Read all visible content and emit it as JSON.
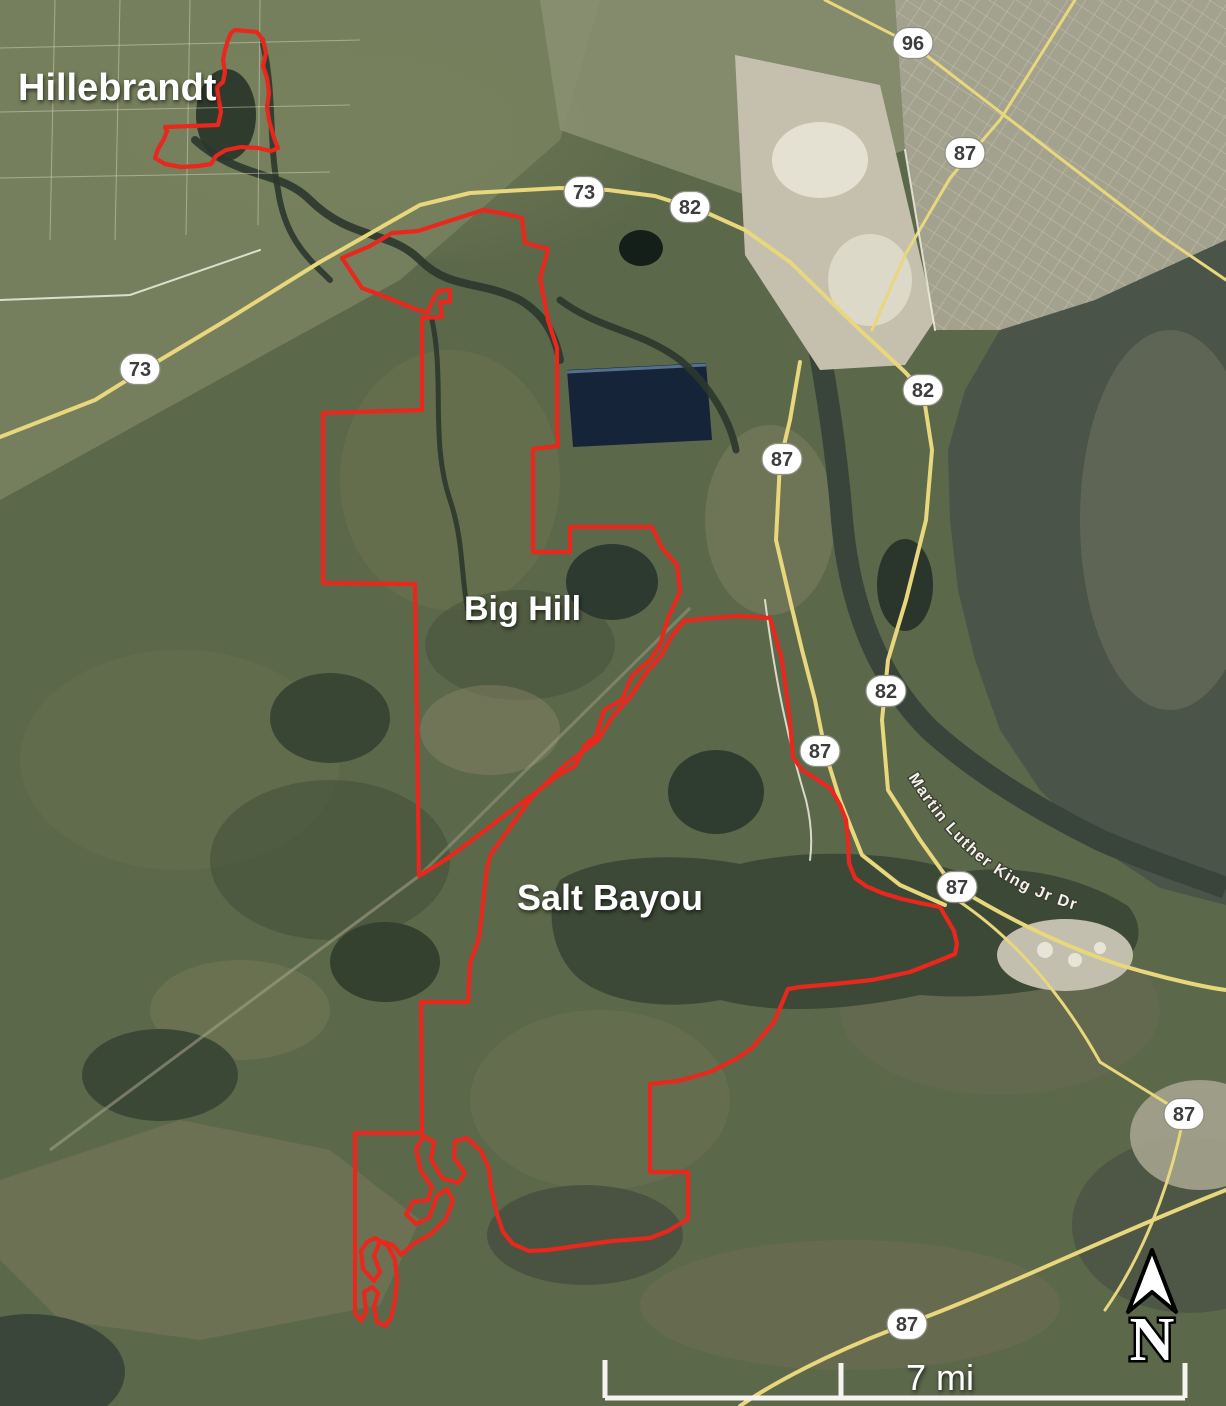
{
  "title": "Satellite map of Hillebrandt, Big Hill and Salt Bayou management areas",
  "labels": {
    "area_hillebrandt": "Hillebrandt",
    "area_big_hill": "Big Hill",
    "area_salt_bayou": "Salt Bayou",
    "road_mlk": "Martin Luther King Jr Dr"
  },
  "north_arrow": {
    "letter": "N"
  },
  "scale_bar": {
    "label": "7 mi"
  },
  "colors": {
    "boundary_red": "#e8271d",
    "highway_yellow": "#e8d77c",
    "water_dark": "#3d4937",
    "urban_gray": "#a3a28e",
    "label_white": "#ffffff"
  },
  "shields": [
    {
      "route": "96",
      "x": 913,
      "y": 43
    },
    {
      "route": "87",
      "x": 965,
      "y": 153
    },
    {
      "route": "73",
      "x": 584,
      "y": 192
    },
    {
      "route": "82",
      "x": 690,
      "y": 207
    },
    {
      "route": "73",
      "x": 140,
      "y": 369
    },
    {
      "route": "82",
      "x": 923,
      "y": 390
    },
    {
      "route": "87",
      "x": 782,
      "y": 459
    },
    {
      "route": "82",
      "x": 886,
      "y": 691
    },
    {
      "route": "87",
      "x": 820,
      "y": 751
    },
    {
      "route": "87",
      "x": 957,
      "y": 887
    },
    {
      "route": "87",
      "x": 1184,
      "y": 1114
    },
    {
      "route": "87",
      "x": 907,
      "y": 1324
    }
  ],
  "boundaries": {
    "hillebrandt": [
      [
        235,
        30
      ],
      [
        257,
        32
      ],
      [
        263,
        40
      ],
      [
        266,
        53
      ],
      [
        263,
        66
      ],
      [
        267,
        78
      ],
      [
        269,
        93
      ],
      [
        267,
        107
      ],
      [
        269,
        120
      ],
      [
        274,
        138
      ],
      [
        278,
        148
      ],
      [
        271,
        151
      ],
      [
        258,
        148
      ],
      [
        241,
        147
      ],
      [
        226,
        150
      ],
      [
        216,
        156
      ],
      [
        211,
        164
      ],
      [
        198,
        166
      ],
      [
        181,
        167
      ],
      [
        165,
        164
      ],
      [
        155,
        158
      ],
      [
        158,
        149
      ],
      [
        164,
        139
      ],
      [
        167,
        131
      ],
      [
        165,
        127
      ],
      [
        218,
        125
      ],
      [
        221,
        112
      ],
      [
        218,
        95
      ],
      [
        217,
        87
      ],
      [
        223,
        82
      ],
      [
        225,
        72
      ],
      [
        223,
        60
      ],
      [
        225,
        50
      ],
      [
        228,
        40
      ],
      [
        231,
        33
      ]
    ],
    "big_hill": [
      [
        342,
        258
      ],
      [
        370,
        246
      ],
      [
        392,
        233
      ],
      [
        418,
        231
      ],
      [
        452,
        220
      ],
      [
        483,
        210
      ],
      [
        506,
        214
      ],
      [
        522,
        218
      ],
      [
        525,
        243
      ],
      [
        548,
        249
      ],
      [
        543,
        268
      ],
      [
        540,
        278
      ],
      [
        548,
        320
      ],
      [
        557,
        348
      ],
      [
        557,
        428
      ],
      [
        558,
        446
      ],
      [
        533,
        449
      ],
      [
        533,
        552
      ],
      [
        570,
        552
      ],
      [
        570,
        527
      ],
      [
        652,
        527
      ],
      [
        662,
        548
      ],
      [
        677,
        565
      ],
      [
        680,
        592
      ],
      [
        668,
        618
      ],
      [
        660,
        645
      ],
      [
        650,
        660
      ],
      [
        632,
        676
      ],
      [
        622,
        700
      ],
      [
        604,
        710
      ],
      [
        596,
        736
      ],
      [
        585,
        745
      ],
      [
        575,
        766
      ],
      [
        560,
        774
      ],
      [
        535,
        793
      ],
      [
        505,
        815
      ],
      [
        475,
        838
      ],
      [
        445,
        860
      ],
      [
        419,
        876
      ],
      [
        415,
        584
      ],
      [
        323,
        583
      ],
      [
        323,
        413
      ],
      [
        422,
        410
      ],
      [
        422,
        318
      ],
      [
        442,
        317
      ],
      [
        440,
        302
      ],
      [
        450,
        302
      ],
      [
        450,
        290
      ],
      [
        438,
        291
      ],
      [
        433,
        300
      ],
      [
        427,
        313
      ],
      [
        410,
        307
      ],
      [
        386,
        297
      ],
      [
        362,
        288
      ]
    ],
    "salt_bayou": [
      [
        770,
        618
      ],
      [
        782,
        660
      ],
      [
        790,
        722
      ],
      [
        793,
        757
      ],
      [
        802,
        770
      ],
      [
        818,
        780
      ],
      [
        831,
        789
      ],
      [
        840,
        805
      ],
      [
        846,
        820
      ],
      [
        848,
        840
      ],
      [
        849,
        863
      ],
      [
        855,
        878
      ],
      [
        866,
        886
      ],
      [
        882,
        893
      ],
      [
        902,
        899
      ],
      [
        920,
        903
      ],
      [
        940,
        907
      ],
      [
        947,
        919
      ],
      [
        954,
        931
      ],
      [
        957,
        944
      ],
      [
        955,
        954
      ],
      [
        938,
        961
      ],
      [
        910,
        972
      ],
      [
        872,
        980
      ],
      [
        834,
        984
      ],
      [
        800,
        987
      ],
      [
        788,
        989
      ],
      [
        774,
        1022
      ],
      [
        752,
        1048
      ],
      [
        736,
        1059
      ],
      [
        710,
        1072
      ],
      [
        678,
        1081
      ],
      [
        650,
        1084
      ],
      [
        650,
        1172
      ],
      [
        688,
        1172
      ],
      [
        688,
        1219
      ],
      [
        668,
        1231
      ],
      [
        650,
        1238
      ],
      [
        612,
        1241
      ],
      [
        576,
        1246
      ],
      [
        548,
        1250
      ],
      [
        529,
        1251
      ],
      [
        513,
        1244
      ],
      [
        503,
        1232
      ],
      [
        497,
        1214
      ],
      [
        491,
        1188
      ],
      [
        489,
        1169
      ],
      [
        481,
        1151
      ],
      [
        467,
        1138
      ],
      [
        455,
        1141
      ],
      [
        454,
        1158
      ],
      [
        465,
        1173
      ],
      [
        458,
        1183
      ],
      [
        442,
        1178
      ],
      [
        431,
        1159
      ],
      [
        434,
        1142
      ],
      [
        424,
        1136
      ],
      [
        416,
        1149
      ],
      [
        421,
        1171
      ],
      [
        432,
        1187
      ],
      [
        428,
        1200
      ],
      [
        413,
        1202
      ],
      [
        406,
        1214
      ],
      [
        416,
        1224
      ],
      [
        429,
        1218
      ],
      [
        437,
        1196
      ],
      [
        447,
        1189
      ],
      [
        453,
        1200
      ],
      [
        446,
        1219
      ],
      [
        431,
        1234
      ],
      [
        413,
        1244
      ],
      [
        401,
        1255
      ],
      [
        393,
        1245
      ],
      [
        380,
        1241
      ],
      [
        374,
        1256
      ],
      [
        380,
        1272
      ],
      [
        374,
        1281
      ],
      [
        363,
        1269
      ],
      [
        361,
        1251
      ],
      [
        367,
        1242
      ],
      [
        375,
        1238
      ],
      [
        388,
        1246
      ],
      [
        395,
        1260
      ],
      [
        397,
        1280
      ],
      [
        395,
        1300
      ],
      [
        391,
        1318
      ],
      [
        385,
        1326
      ],
      [
        377,
        1322
      ],
      [
        374,
        1307
      ],
      [
        378,
        1293
      ],
      [
        372,
        1287
      ],
      [
        364,
        1292
      ],
      [
        366,
        1311
      ],
      [
        361,
        1321
      ],
      [
        355,
        1313
      ],
      [
        355,
        1133
      ],
      [
        422,
        1133
      ],
      [
        421,
        1002
      ],
      [
        468,
        1002
      ],
      [
        470,
        963
      ],
      [
        479,
        938
      ],
      [
        487,
        868
      ],
      [
        491,
        854
      ],
      [
        532,
        797
      ],
      [
        566,
        764
      ],
      [
        598,
        740
      ],
      [
        613,
        716
      ],
      [
        631,
        696
      ],
      [
        646,
        673
      ],
      [
        661,
        656
      ],
      [
        671,
        637
      ],
      [
        684,
        621
      ],
      [
        710,
        618
      ],
      [
        740,
        616
      ]
    ]
  }
}
